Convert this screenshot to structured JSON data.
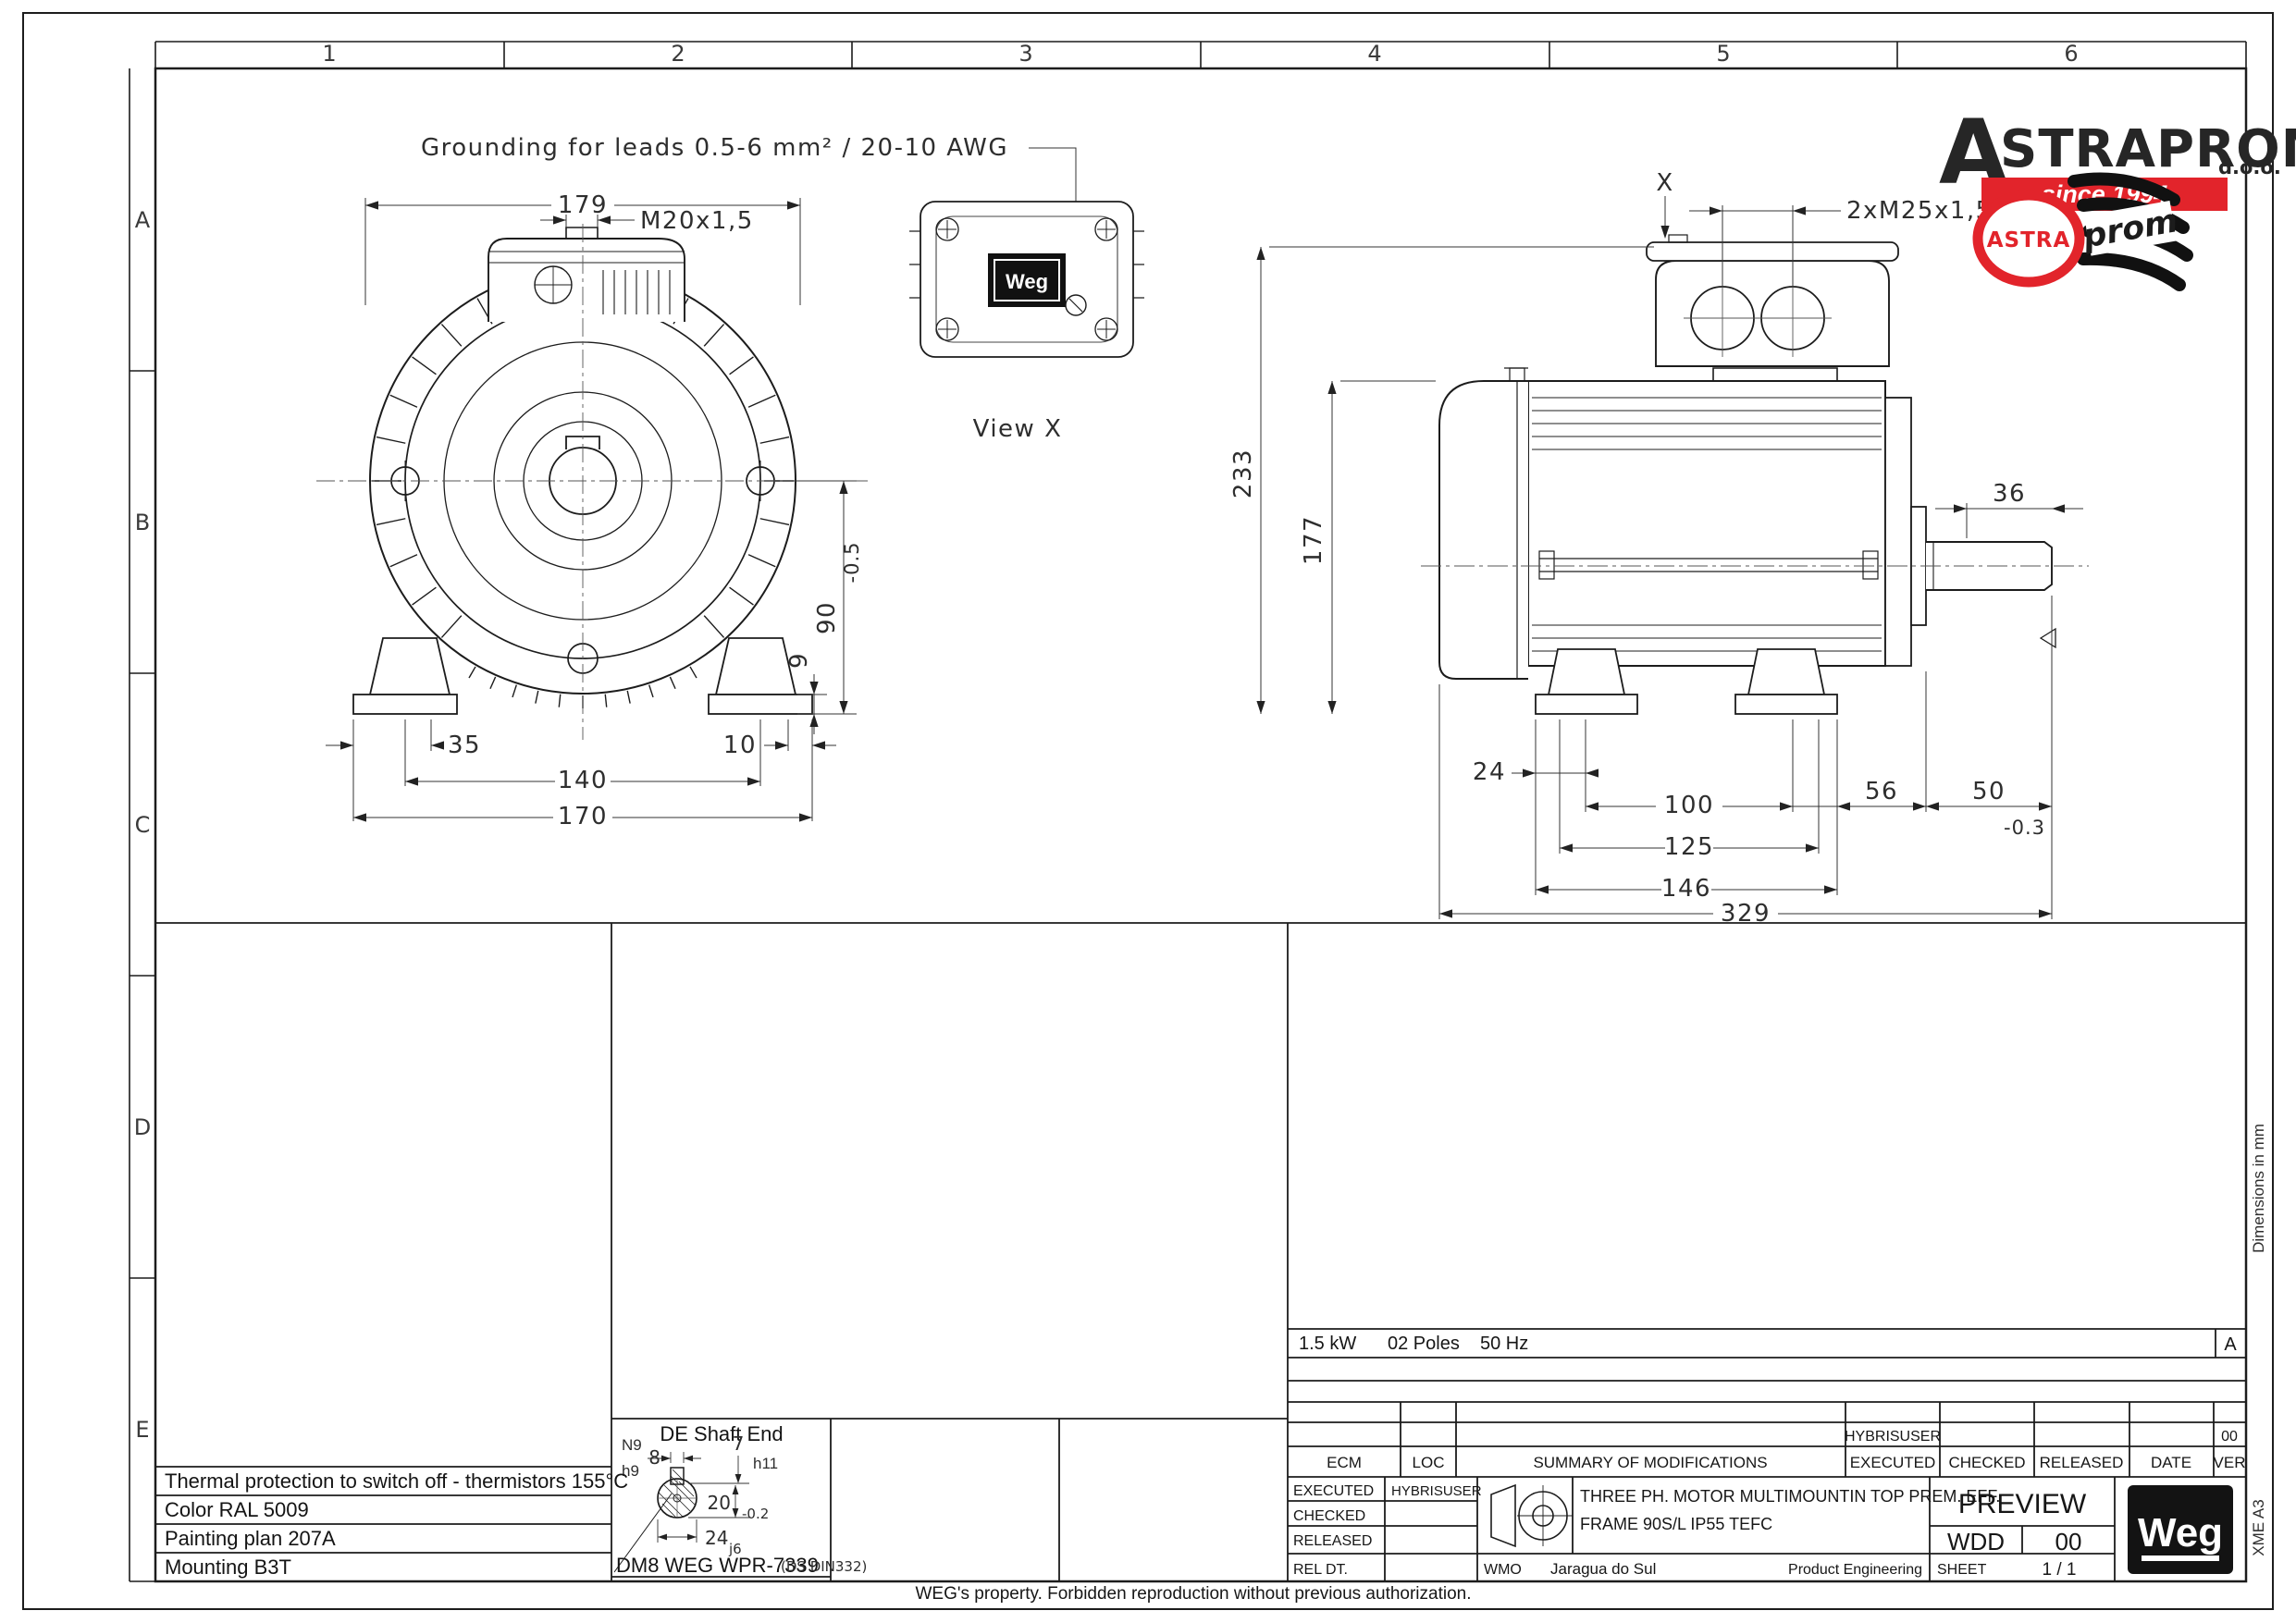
{
  "colors": {
    "ink": "#1c1c1c",
    "accent_red": "#e2242b",
    "paper": "#ffffff"
  },
  "grid": {
    "cols": [
      "1",
      "2",
      "3",
      "4",
      "5",
      "6"
    ],
    "rows": [
      "A",
      "B",
      "C",
      "D",
      "E"
    ]
  },
  "ann": {
    "grounding": "Grounding for leads 0.5-6 mm² / 20-10 AWG",
    "view_x": "View X",
    "dim_unit": "Dimensions in mm",
    "margin_code": "XME    A3",
    "footer": "WEG's property. Forbidden reproduction without previous authorization."
  },
  "front": {
    "d179": "179",
    "m20": "M20x1,5",
    "d35": "35",
    "d10": "10",
    "d140": "140",
    "d170": "170",
    "d90": "90",
    "t05": "-0.5",
    "d9": "9"
  },
  "side": {
    "x": "X",
    "m25": "2xM25x1,5",
    "d233": "233",
    "d177": "177",
    "d36": "36",
    "d24": "24",
    "d100": "100",
    "d125": "125",
    "d146": "146",
    "d56": "56",
    "d50": "50",
    "t03": "-0.3",
    "d329": "329"
  },
  "shaft": {
    "title": "DE Shaft End",
    "n9": "N9",
    "h9": "h9",
    "d8": "8",
    "d7": "7",
    "h11": "h11",
    "d20": "20",
    "t02": "-0.2",
    "d24": "24",
    "j6": "j6",
    "code": "DM8 WEG WPR-7339",
    "std": "(DS DIN332)"
  },
  "spec_notes": [
    "Thermal protection to switch off - thermistors 155°C",
    "Color RAL 5009",
    "Painting plan 207A",
    "Mounting B3T"
  ],
  "rating": {
    "power": "1.5 kW",
    "poles": "02 Poles",
    "freq": "50 Hz",
    "rev": "A"
  },
  "rev_table": {
    "headers": [
      "ECM",
      "LOC",
      "SUMMARY OF MODIFICATIONS",
      "EXECUTED",
      "CHECKED",
      "RELEASED",
      "DATE",
      "VER"
    ],
    "row": {
      "executed": "HYBRISUSER",
      "ver": "00"
    }
  },
  "approval": {
    "executed": "EXECUTED",
    "executed_by": "HYBRISUSER",
    "checked": "CHECKED",
    "released": "RELEASED",
    "rel_dt": "REL DT."
  },
  "desc": {
    "line1": "THREE PH. MOTOR  MULTIMOUNTIN   TOP PREM. EFF.",
    "line2": "FRAME 90S/L IP55 TEFC"
  },
  "site": {
    "code": "WMO",
    "plant": "Jaragua do Sul",
    "dept": "Product Engineering"
  },
  "doc": {
    "status": "PREVIEW",
    "type": "WDD",
    "rev": "00",
    "sheet_label": "SHEET",
    "sheet": "1 / 1"
  },
  "brand": {
    "wordmark_a": "A",
    "wordmark": "STRAPROM",
    "doo": "d.o.o.",
    "since": "since 1994",
    "badge_astra": "ASTRA",
    "badge_prom": "prom",
    "weg": "Weg"
  }
}
